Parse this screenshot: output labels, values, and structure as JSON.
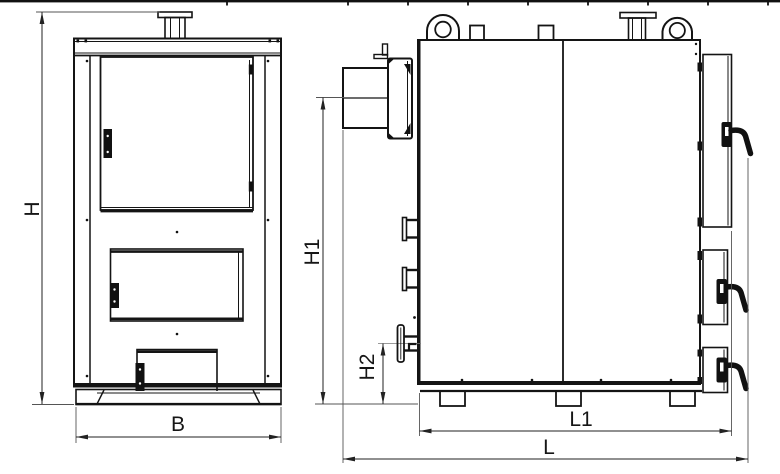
{
  "drawing": {
    "type": "technical-drawing-boiler",
    "background": "#ffffff",
    "line_color": "#141414",
    "views": {
      "front": {
        "name": "boiler-front-view",
        "dimensions": {
          "overall_height": {
            "label": "H"
          },
          "overall_width": {
            "label": "B"
          }
        }
      },
      "side": {
        "name": "boiler-side-view",
        "dimensions": {
          "flue_outlet_height": {
            "label": "H1"
          },
          "return_connection_height": {
            "label": "H2"
          },
          "body_depth": {
            "label": "L1"
          },
          "overall_depth": {
            "label": "L"
          }
        }
      }
    }
  }
}
